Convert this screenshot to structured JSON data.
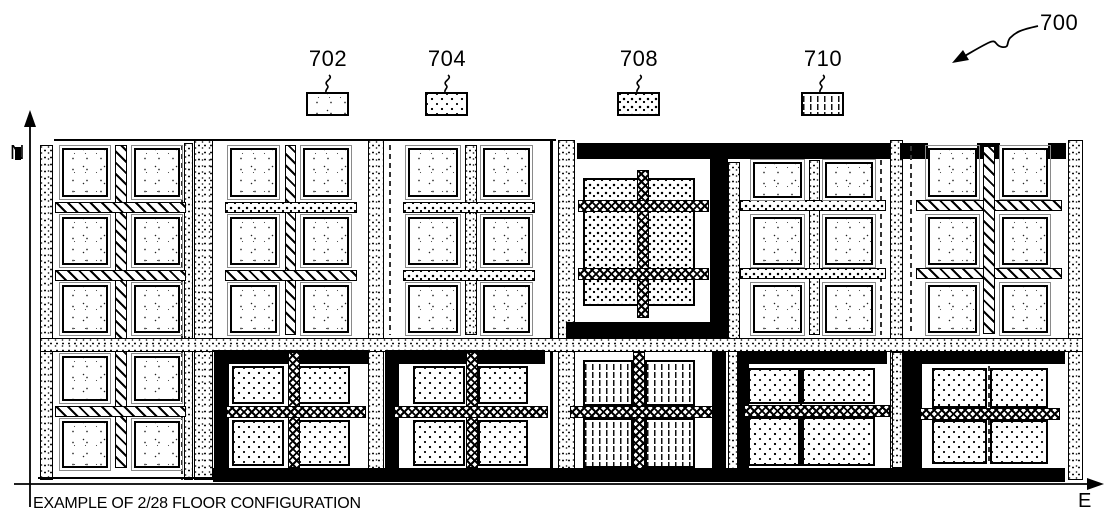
{
  "figure_ref": "700",
  "axes": {
    "north": "N",
    "east": "E"
  },
  "caption": "EXAMPLE OF 2/28 FLOOR CONFIGURATION",
  "legend": [
    {
      "ref": "702",
      "pattern": "p-stipple",
      "meaning": "sparse-stipple-region"
    },
    {
      "ref": "704",
      "pattern": "p-d4",
      "meaning": "dotted-region"
    },
    {
      "ref": "708",
      "pattern": "p-d8",
      "meaning": "coarse-dotted-region"
    },
    {
      "ref": "710",
      "pattern": "p-vd",
      "meaning": "vertical-dash-region"
    }
  ],
  "colors": {
    "ink": "#000000",
    "paper": "#ffffff"
  },
  "figure": {
    "rects": [
      [
        54,
        139,
        502,
        2,
        "ink",
        "top-boundary-line"
      ],
      [
        40,
        145,
        13,
        335,
        "p-grit b1",
        "edge-strip-west"
      ],
      [
        181,
        145,
        2,
        335,
        "dashv",
        "divider-a-east"
      ],
      [
        184,
        143,
        9,
        337,
        "p-grit b1",
        "edge-strip-a-east"
      ],
      [
        194,
        140,
        19,
        340,
        "p-grit b1",
        "strip-a-b"
      ],
      [
        115,
        145,
        12,
        323,
        "p-hatch b1",
        "vertical-channel-a"
      ],
      [
        55,
        202,
        131,
        11,
        "p-hatch b1",
        "horizontal-channel-a1"
      ],
      [
        55,
        270,
        131,
        11,
        "p-hatch b1",
        "horizontal-channel-a2"
      ],
      [
        62,
        148,
        46,
        49,
        "p-stipple b2 outl",
        "core-tile"
      ],
      [
        134,
        148,
        46,
        49,
        "p-stipple b2 outl",
        "core-tile"
      ],
      [
        62,
        217,
        46,
        48,
        "p-stipple b2 outl",
        "core-tile"
      ],
      [
        134,
        217,
        46,
        48,
        "p-stipple b2 outl",
        "core-tile"
      ],
      [
        62,
        285,
        46,
        48,
        "p-stipple b2 outl",
        "core-tile"
      ],
      [
        134,
        285,
        46,
        48,
        "p-stipple b2 outl",
        "core-tile"
      ],
      [
        368,
        140,
        16,
        340,
        "p-grit b1",
        "strip-b-c"
      ],
      [
        285,
        145,
        11,
        190,
        "p-hatch b1",
        "vertical-channel-b"
      ],
      [
        225,
        202,
        132,
        11,
        "p-d8 b1",
        "horizontal-channel-b1"
      ],
      [
        225,
        270,
        132,
        11,
        "p-hatch b1",
        "horizontal-channel-b2"
      ],
      [
        230,
        148,
        47,
        49,
        "p-stipple b2 outl",
        "core-tile"
      ],
      [
        303,
        148,
        46,
        49,
        "p-stipple b2 outl",
        "core-tile"
      ],
      [
        230,
        217,
        47,
        48,
        "p-stipple b2 outl",
        "core-tile"
      ],
      [
        303,
        217,
        46,
        48,
        "p-stipple b2 outl",
        "core-tile"
      ],
      [
        230,
        285,
        47,
        48,
        "p-stipple b2 outl",
        "core-tile"
      ],
      [
        303,
        285,
        46,
        48,
        "p-stipple b2 outl",
        "core-tile"
      ],
      [
        389,
        145,
        2,
        190,
        "dashv",
        "divider-c-west"
      ],
      [
        465,
        145,
        12,
        190,
        "p-grit b1",
        "vertical-channel-c"
      ],
      [
        403,
        202,
        132,
        11,
        "p-d8 b1",
        "horizontal-channel-c1"
      ],
      [
        403,
        270,
        132,
        11,
        "p-d8 b1",
        "horizontal-channel-c2"
      ],
      [
        408,
        148,
        50,
        49,
        "p-stipple b2 outl",
        "core-tile"
      ],
      [
        483,
        148,
        47,
        49,
        "p-stipple b2 outl",
        "core-tile"
      ],
      [
        408,
        217,
        50,
        48,
        "p-stipple b2 outl",
        "core-tile"
      ],
      [
        483,
        217,
        47,
        48,
        "p-stipple b2 outl",
        "core-tile"
      ],
      [
        408,
        285,
        50,
        48,
        "p-stipple b2 outl",
        "core-tile"
      ],
      [
        483,
        285,
        47,
        48,
        "p-stipple b2 outl",
        "core-tile"
      ],
      [
        550,
        140,
        3,
        340,
        "ink",
        "boundary-c-d"
      ],
      [
        558,
        140,
        17,
        340,
        "p-grit b1",
        "strip-c-d"
      ],
      [
        577,
        143,
        326,
        16,
        "ink",
        "north-power-bar"
      ],
      [
        710,
        159,
        18,
        176,
        "ink",
        "frame-d-east"
      ],
      [
        566,
        322,
        174,
        16,
        "ink",
        "frame-d-south"
      ],
      [
        583,
        178,
        112,
        128,
        "p-d8 b2",
        "macro-block-708"
      ],
      [
        637,
        170,
        12,
        148,
        "p-xhatch b1",
        "crosshatch-channel-d-v"
      ],
      [
        578,
        200,
        131,
        12,
        "p-xhatch b1",
        "crosshatch-channel-d-h1"
      ],
      [
        578,
        268,
        131,
        12,
        "p-xhatch b1",
        "crosshatch-channel-d-h2"
      ],
      [
        728,
        162,
        12,
        318,
        "p-grit b1",
        "strip-d-e"
      ],
      [
        809,
        160,
        11,
        175,
        "p-grit b1",
        "vertical-channel-e"
      ],
      [
        880,
        160,
        2,
        175,
        "dashv",
        "divider-e-east"
      ],
      [
        740,
        200,
        146,
        11,
        "p-d8 b1",
        "horizontal-channel-e1"
      ],
      [
        740,
        268,
        146,
        11,
        "p-d8 b1",
        "horizontal-channel-e2"
      ],
      [
        753,
        162,
        49,
        36,
        "p-stipple b2 outl",
        "core-tile"
      ],
      [
        825,
        162,
        48,
        36,
        "p-stipple b2 outl",
        "core-tile"
      ],
      [
        753,
        217,
        49,
        48,
        "p-stipple b2 outl",
        "core-tile"
      ],
      [
        825,
        217,
        48,
        48,
        "p-stipple b2 outl",
        "core-tile"
      ],
      [
        753,
        285,
        49,
        48,
        "p-stipple b2 outl",
        "core-tile"
      ],
      [
        825,
        285,
        48,
        48,
        "p-stipple b2 outl",
        "core-tile"
      ],
      [
        890,
        140,
        13,
        340,
        "p-grit b1",
        "strip-e-f"
      ],
      [
        900,
        143,
        28,
        16,
        "ink",
        "f-north-bar-1"
      ],
      [
        977,
        143,
        23,
        16,
        "ink",
        "f-north-bar-2"
      ],
      [
        1048,
        143,
        18,
        16,
        "ink",
        "f-north-bar-3"
      ],
      [
        910,
        146,
        2,
        188,
        "dashv",
        "divider-f-west"
      ],
      [
        916,
        200,
        146,
        11,
        "p-hatch b1",
        "horizontal-channel-f1"
      ],
      [
        916,
        268,
        146,
        11,
        "p-hatch b1",
        "horizontal-channel-f2"
      ],
      [
        983,
        146,
        12,
        188,
        "p-hatch b1",
        "vertical-channel-f"
      ],
      [
        928,
        148,
        49,
        49,
        "p-stipple b2 outl",
        "core-tile"
      ],
      [
        1002,
        148,
        46,
        49,
        "p-stipple b2 outl",
        "core-tile"
      ],
      [
        928,
        217,
        49,
        48,
        "p-stipple b2 outl",
        "core-tile"
      ],
      [
        1002,
        217,
        46,
        48,
        "p-stipple b2 outl",
        "core-tile"
      ],
      [
        928,
        285,
        49,
        48,
        "p-stipple b2 outl",
        "core-tile"
      ],
      [
        1002,
        285,
        46,
        48,
        "p-stipple b2 outl",
        "core-tile"
      ],
      [
        1068,
        140,
        15,
        340,
        "p-grit b1",
        "edge-strip-east"
      ],
      [
        40,
        338,
        1043,
        14,
        "p-grit b1",
        "main-horizontal-channel"
      ],
      [
        55,
        406,
        131,
        11,
        "p-hatch b1",
        "horizontal-channel-a3"
      ],
      [
        62,
        356,
        46,
        45,
        "p-stipple b2 outl",
        "core-tile"
      ],
      [
        134,
        356,
        46,
        45,
        "p-stipple b2 outl",
        "core-tile"
      ],
      [
        62,
        421,
        46,
        47,
        "p-stipple b2 outl",
        "core-tile"
      ],
      [
        134,
        421,
        46,
        47,
        "p-stipple b2 outl",
        "core-tile"
      ],
      [
        214,
        350,
        154,
        14,
        "ink",
        "frame-b2-north"
      ],
      [
        214,
        350,
        15,
        118,
        "ink",
        "frame-b2-west"
      ],
      [
        232,
        366,
        52,
        38,
        "p-d4 b2",
        "dense-tile"
      ],
      [
        298,
        366,
        52,
        38,
        "p-d4 b2",
        "dense-tile"
      ],
      [
        232,
        420,
        52,
        46,
        "p-d4 b2",
        "dense-tile"
      ],
      [
        298,
        420,
        52,
        46,
        "p-d4 b2",
        "dense-tile"
      ],
      [
        288,
        352,
        12,
        116,
        "p-xhatch b1",
        "crosshatch-channel-b2-v"
      ],
      [
        226,
        406,
        140,
        12,
        "p-xhatch b1",
        "crosshatch-channel-b2-h"
      ],
      [
        385,
        350,
        160,
        14,
        "ink",
        "frame-c2-north"
      ],
      [
        385,
        350,
        14,
        118,
        "ink",
        "frame-c2-west"
      ],
      [
        413,
        366,
        52,
        38,
        "p-d4 b2",
        "dense-tile"
      ],
      [
        478,
        366,
        50,
        38,
        "p-d4 b2",
        "dense-tile"
      ],
      [
        413,
        420,
        52,
        46,
        "p-d4 b2",
        "dense-tile"
      ],
      [
        478,
        420,
        50,
        46,
        "p-d4 b2",
        "dense-tile"
      ],
      [
        466,
        352,
        12,
        116,
        "p-xhatch b1",
        "crosshatch-channel-c2-v"
      ],
      [
        394,
        406,
        154,
        12,
        "p-xhatch b1",
        "crosshatch-channel-c2-h"
      ],
      [
        583,
        360,
        50,
        46,
        "p-vd b2",
        "dash-tile"
      ],
      [
        645,
        360,
        50,
        46,
        "p-vd b2",
        "dash-tile"
      ],
      [
        583,
        418,
        50,
        50,
        "p-vd b2",
        "dash-tile"
      ],
      [
        645,
        418,
        50,
        50,
        "p-vd b2",
        "dash-tile"
      ],
      [
        633,
        352,
        12,
        128,
        "p-xhatch b1",
        "crosshatch-channel-d2-v"
      ],
      [
        570,
        406,
        148,
        12,
        "p-xhatch b1",
        "crosshatch-channel-d2-h"
      ],
      [
        712,
        352,
        14,
        116,
        "ink",
        "frame-d2-east"
      ],
      [
        737,
        352,
        150,
        12,
        "ink",
        "frame-e2-north"
      ],
      [
        737,
        352,
        12,
        116,
        "ink",
        "frame-e2-west"
      ],
      [
        748,
        368,
        52,
        36,
        "p-d4 b2",
        "dense-tile"
      ],
      [
        802,
        368,
        73,
        36,
        "p-d4 b2",
        "dense-tile"
      ],
      [
        748,
        417,
        52,
        49,
        "p-d4 b2",
        "dense-tile"
      ],
      [
        802,
        417,
        73,
        49,
        "p-d4 b2",
        "dense-tile"
      ],
      [
        800,
        368,
        2,
        98,
        "ink",
        "tile-divider-e"
      ],
      [
        744,
        405,
        146,
        12,
        "p-xhatch b1",
        "crosshatch-channel-e2-h"
      ],
      [
        892,
        352,
        11,
        116,
        "p-grit b1",
        "strip-e2-east"
      ],
      [
        903,
        352,
        162,
        12,
        "ink",
        "frame-f2-north"
      ],
      [
        903,
        352,
        19,
        118,
        "ink",
        "frame-f2-west"
      ],
      [
        932,
        368,
        55,
        40,
        "p-d4 b2",
        "dense-tile"
      ],
      [
        990,
        368,
        58,
        40,
        "p-d4 b2",
        "dense-tile"
      ],
      [
        932,
        420,
        55,
        44,
        "p-d4 b2",
        "dense-tile"
      ],
      [
        990,
        420,
        58,
        44,
        "p-d4 b2",
        "dense-tile"
      ],
      [
        988,
        366,
        2,
        98,
        "dashv",
        "tile-divider-f"
      ],
      [
        920,
        408,
        140,
        12,
        "p-xhatch b1",
        "crosshatch-channel-f2-h"
      ],
      [
        213,
        468,
        852,
        14,
        "ink",
        "south-power-bar"
      ],
      [
        38,
        477,
        174,
        2,
        "ink",
        "bottom-boundary-line"
      ]
    ]
  }
}
